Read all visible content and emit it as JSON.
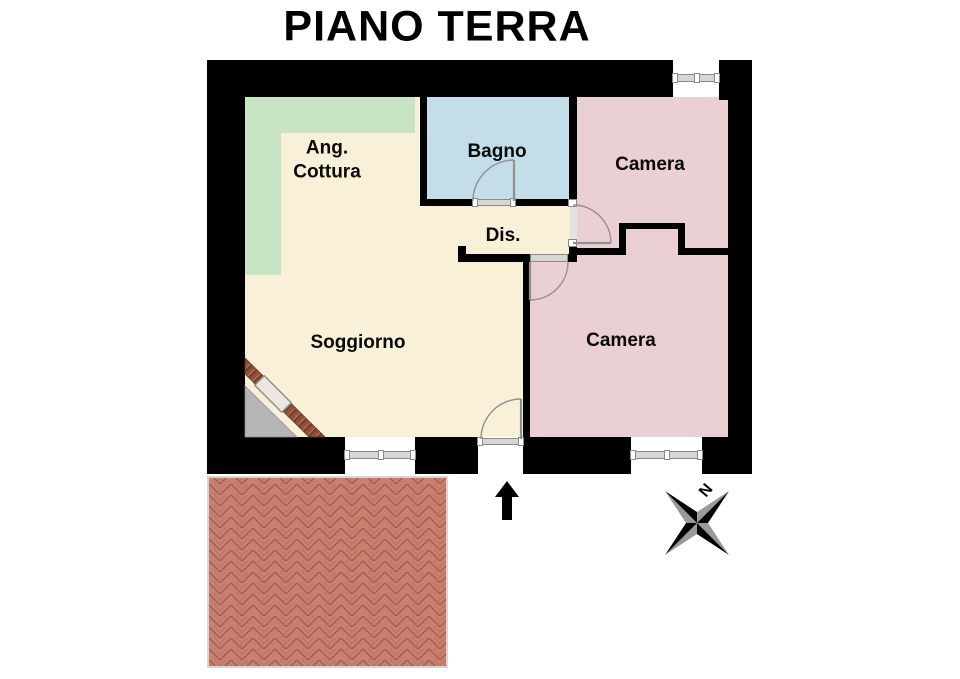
{
  "title": "PIANO TERRA",
  "floor_plan": {
    "rooms": [
      {
        "id": "ang-cottura",
        "label": "Ang.\nCottura",
        "color_key": "kitchen_band"
      },
      {
        "id": "bagno",
        "label": "Bagno",
        "color_key": "bathroom"
      },
      {
        "id": "camera-nord",
        "label": "Camera",
        "color_key": "bedroom"
      },
      {
        "id": "dis",
        "label": "Dis.",
        "color_key": "floor"
      },
      {
        "id": "soggiorno",
        "label": "Soggiorno",
        "color_key": "floor"
      },
      {
        "id": "camera-sud",
        "label": "Camera",
        "color_key": "bedroom"
      }
    ],
    "compass": {
      "north_label": "N"
    },
    "window_count": 3,
    "door_count": 4
  },
  "colors": {
    "wall": "#000000",
    "floor": "#f9f0d8",
    "kitchen_band": "#c9e3c5",
    "bathroom": "#c3dde9",
    "bedroom": "#eacfd3",
    "terrace_brick": "#c9806f",
    "terrace_mortar": "#9d584a",
    "diagonal_brick": "#95503a",
    "exterior_corner": "#b5b5b5",
    "window_bar": "#d6d6d6",
    "window_edge": "#8a8a8a",
    "door_arc": "#909090"
  }
}
